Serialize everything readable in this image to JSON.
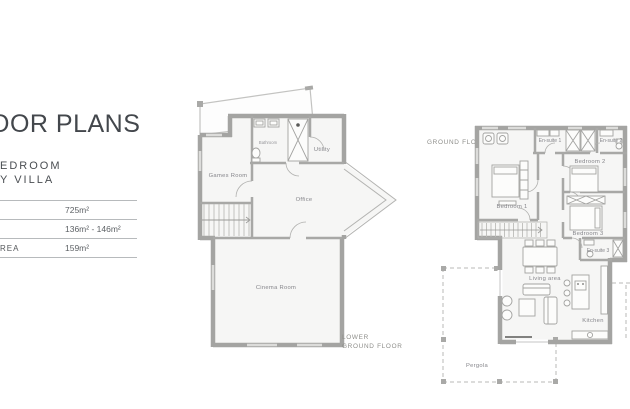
{
  "panel": {
    "title": "OOR PLANS",
    "subtitle_line1": "EDROOM",
    "subtitle_line2": "Y VILLA",
    "spec_rows": [
      {
        "label": "",
        "value": "725m²"
      },
      {
        "label": "",
        "value": "136m² - 146m²"
      },
      {
        "label": "REA",
        "value": "159m²"
      }
    ]
  },
  "lower_plan": {
    "floor_label_line1": "LOWER",
    "floor_label_line2": "GROUND FLOOR",
    "rooms": {
      "games_room": "Games Room",
      "bathroom": "Bathroom",
      "utility": "Utility",
      "office": "Office",
      "cinema_room": "Cinema Room"
    }
  },
  "ground_plan": {
    "floor_label": "GROUND FLOOR",
    "rooms": {
      "bedroom1": "Bedroom 1",
      "bedroom2": "Bedroom 2",
      "bedroom3": "Bedroom 3",
      "ensuite1": "En-suite 1",
      "ensuite2": "En-suite 2",
      "ensuite3": "En-suite 3",
      "living_area": "Living area",
      "kitchen": "Kitchen",
      "pergola": "Pergola"
    }
  },
  "colors": {
    "wall": "#a4a4a2",
    "room_fill": "#f6f6f5",
    "heading": "#43474c",
    "label_gray": "#8e8e8a"
  }
}
